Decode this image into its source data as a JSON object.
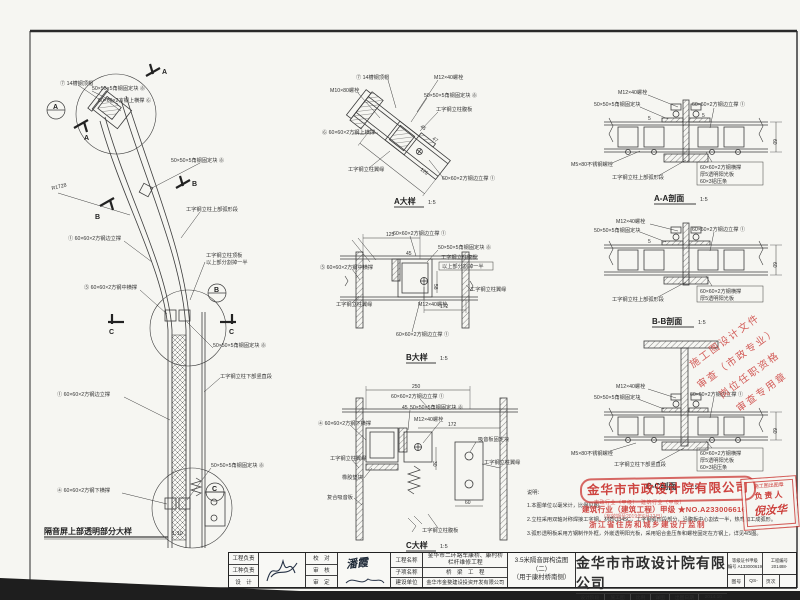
{
  "palette": {
    "red": "#c9302c",
    "line": "#3c3c3c",
    "paper": "#f6f6f2"
  },
  "elevation": {
    "title": "隔音屏上部透明部分大样",
    "scale": "1:10",
    "labels": {
      "cap": "⑦ 14槽钢顶帽",
      "fix_top": "50×50×5角钢固定块 ⑧",
      "top_rail": "60×60×2方钢上横撑 ⑥",
      "radius": "R1728",
      "fix_mid": "50×50×5角钢固定块 ⑧",
      "arc_seg": "工字钢立柱上部弧形段",
      "edge_post_top": "① 60×60×2方钢边立撑",
      "top_plate": "工字钢立柱顶板",
      "cut_half": "以上部分割掉一半",
      "mid_rail": "⑤ 60×60×2方钢中横撑",
      "fix_low": "50×50×5角钢固定块 ⑧",
      "straight_seg": "工字钢立柱下部竖直段",
      "edge_post_low": "① 60×60×2方钢边立撑",
      "fix_bot": "50×50×5角钢固定块 ⑧",
      "bot_rail": "④ 60×60×2方钢下横撑"
    },
    "markers": {
      "a": "A",
      "b": "B",
      "c": "C"
    }
  },
  "detailA": {
    "title": "A大样",
    "scale": "1:5",
    "labels": {
      "cap": "⑦ 14槽钢顶帽",
      "bolt": "M12×40螺栓",
      "bolt2": "M10×80螺栓",
      "fix": "50×50×5角钢固定块 ⑧",
      "web": "工字钢立柱腹板",
      "rail": "⑥ 60×60×2方钢上横撑",
      "flange": "工字钢立柱翼缘",
      "post": "60×60×2方钢边立撑 ①"
    },
    "dims": {
      "d45": "45",
      "d47": "47",
      "d125": "125"
    }
  },
  "detailB": {
    "title": "B大样",
    "scale": "1:5",
    "labels": {
      "post_top": "60×60×2方钢边立撑 ①",
      "fix": "50×50×5角钢固定块 ⑧",
      "web": "工字钢立柱腹板",
      "cut": "以上部分割掉一半",
      "rail": "⑤ 60×60×2方钢中横撑",
      "flangeL": "工字钢立柱翼缘",
      "flangeR": "工字钢立柱翼缘",
      "bolt": "M12×40螺栓",
      "post_bot": "60×60×2方钢边立撑 ①"
    },
    "dims": {
      "d125": "125",
      "d45": "45",
      "d58": "58",
      "d172": "172"
    }
  },
  "detailC": {
    "title": "C大样",
    "scale": "1:5",
    "labels": {
      "post": "60×60×2方钢边立撑 ①",
      "fix": "50×50×5角钢固定块 ⑧",
      "bolt": "M12×40螺栓",
      "rail": "④ 60×60×2方钢下横撑",
      "flangeL": "工字钢立柱翼缘",
      "rubber": "橡胶垫块",
      "absorb": "复合吸音板",
      "fixblock": "吸音板固定块",
      "flangeR": "工字钢立柱翼缘",
      "web": "工字钢立柱腹板"
    },
    "dims": {
      "d250": "250",
      "d45": "45",
      "d172": "172",
      "d30": "30",
      "d60": "60"
    }
  },
  "sectionAA": {
    "title": "A-A剖面",
    "scale": "1:5",
    "labels": {
      "bolt": "M12×40螺栓",
      "fix": "50×50×5角钢固定块",
      "post": "60×60×2方钢边立撑 ①",
      "ss": "M5×80不锈钢螺栓",
      "seg": "工字钢立柱上部弧形段",
      "s1": "60×60×2方钢横撑",
      "s2": "厚5透明阳光板",
      "s3": "60×3铝压条",
      "d60": "60",
      "d5": "5"
    }
  },
  "sectionBB": {
    "title": "B-B剖面",
    "scale": "1:5",
    "labels": {
      "bolt": "M12×40螺栓",
      "fix": "50×50×5角钢固定块",
      "post": "60×60×2方钢边立撑 ①",
      "seg": "工字钢立柱上部弧形段",
      "s1": "60×60×2方钢横撑",
      "s2": "厚5透明阳光板",
      "d60": "60",
      "d5": "5"
    }
  },
  "sectionCC": {
    "title": "C-C剖面",
    "scale": "1:5",
    "labels": {
      "bolt": "M12×40螺栓",
      "fix": "50×50×5角钢固定块",
      "post": "60×60×2方钢边立撑 ①",
      "ss": "M5×80不锈钢螺栓",
      "seg": "工字钢立柱下部竖直段",
      "s1": "60×60×2方钢横撑",
      "s2": "厚5透明阳光板",
      "s3": "60×3铝压条",
      "d60": "60"
    }
  },
  "notes": {
    "header": "说明：",
    "n1": "1.本图单位以毫米计，比例见图。",
    "n2": "2.立柱采用双轴对称焊接工字钢，材质Q345C，工字钢弧形段部分，沿腹板中心割去一半，热弯加工成弧形。",
    "n3": "3.弧形透明板采用方钢制作外框，外嵌透明阳光板，采用铝合金压条和螺栓固定在方钢上，详见4/5图。"
  },
  "stamps": {
    "tilted": [
      "施工图设计文件",
      "审查（市政专业）",
      "岗位任职资格",
      "审查专用章"
    ],
    "company": "金华市市政设计院有限公司",
    "quals": "市政行业（甲级）　建筑行业（甲级）",
    "cert_no": "建筑行业（建筑工程）甲级 ★NO.A233006616",
    "validity": "（有效期至2019年6月12日）",
    "issuer": "浙江省住房和城乡建设厅监制",
    "out_title": "施工图出图章",
    "out_role": "负责人",
    "out_name": "倪汝华"
  },
  "titleblock": {
    "col1": [
      "工程负责",
      "工种负责",
      "设　计"
    ],
    "col2": [
      "校　对",
      "审　核",
      "审　定"
    ],
    "sign_proof": "潘霞",
    "labels": [
      "工程名称",
      "子项名称",
      "建设单位"
    ],
    "project_name1": "金华市二环路车康桥、康村桥",
    "project_name2": "栏杆维修工程",
    "sub_name": "桥　梁　工　程",
    "client": "金华市金婺建设投资开发有限公司",
    "fig1": "3.5米隔音屏构造图",
    "fig2": "（二）",
    "fig3": "（用于康村桥南侧）",
    "company": "金华市市政设计院有限公司",
    "cert1": "等级证书甲级",
    "cert2": "编号 A133000619",
    "pn_label": "工程编号",
    "pn": "201488-",
    "row_h": [
      "设计阶段",
      "施工图",
      "比例",
      "详图",
      "出图日期",
      "2014.10"
    ],
    "row_i": [
      "图号",
      "QS-",
      "页次",
      ""
    ]
  }
}
